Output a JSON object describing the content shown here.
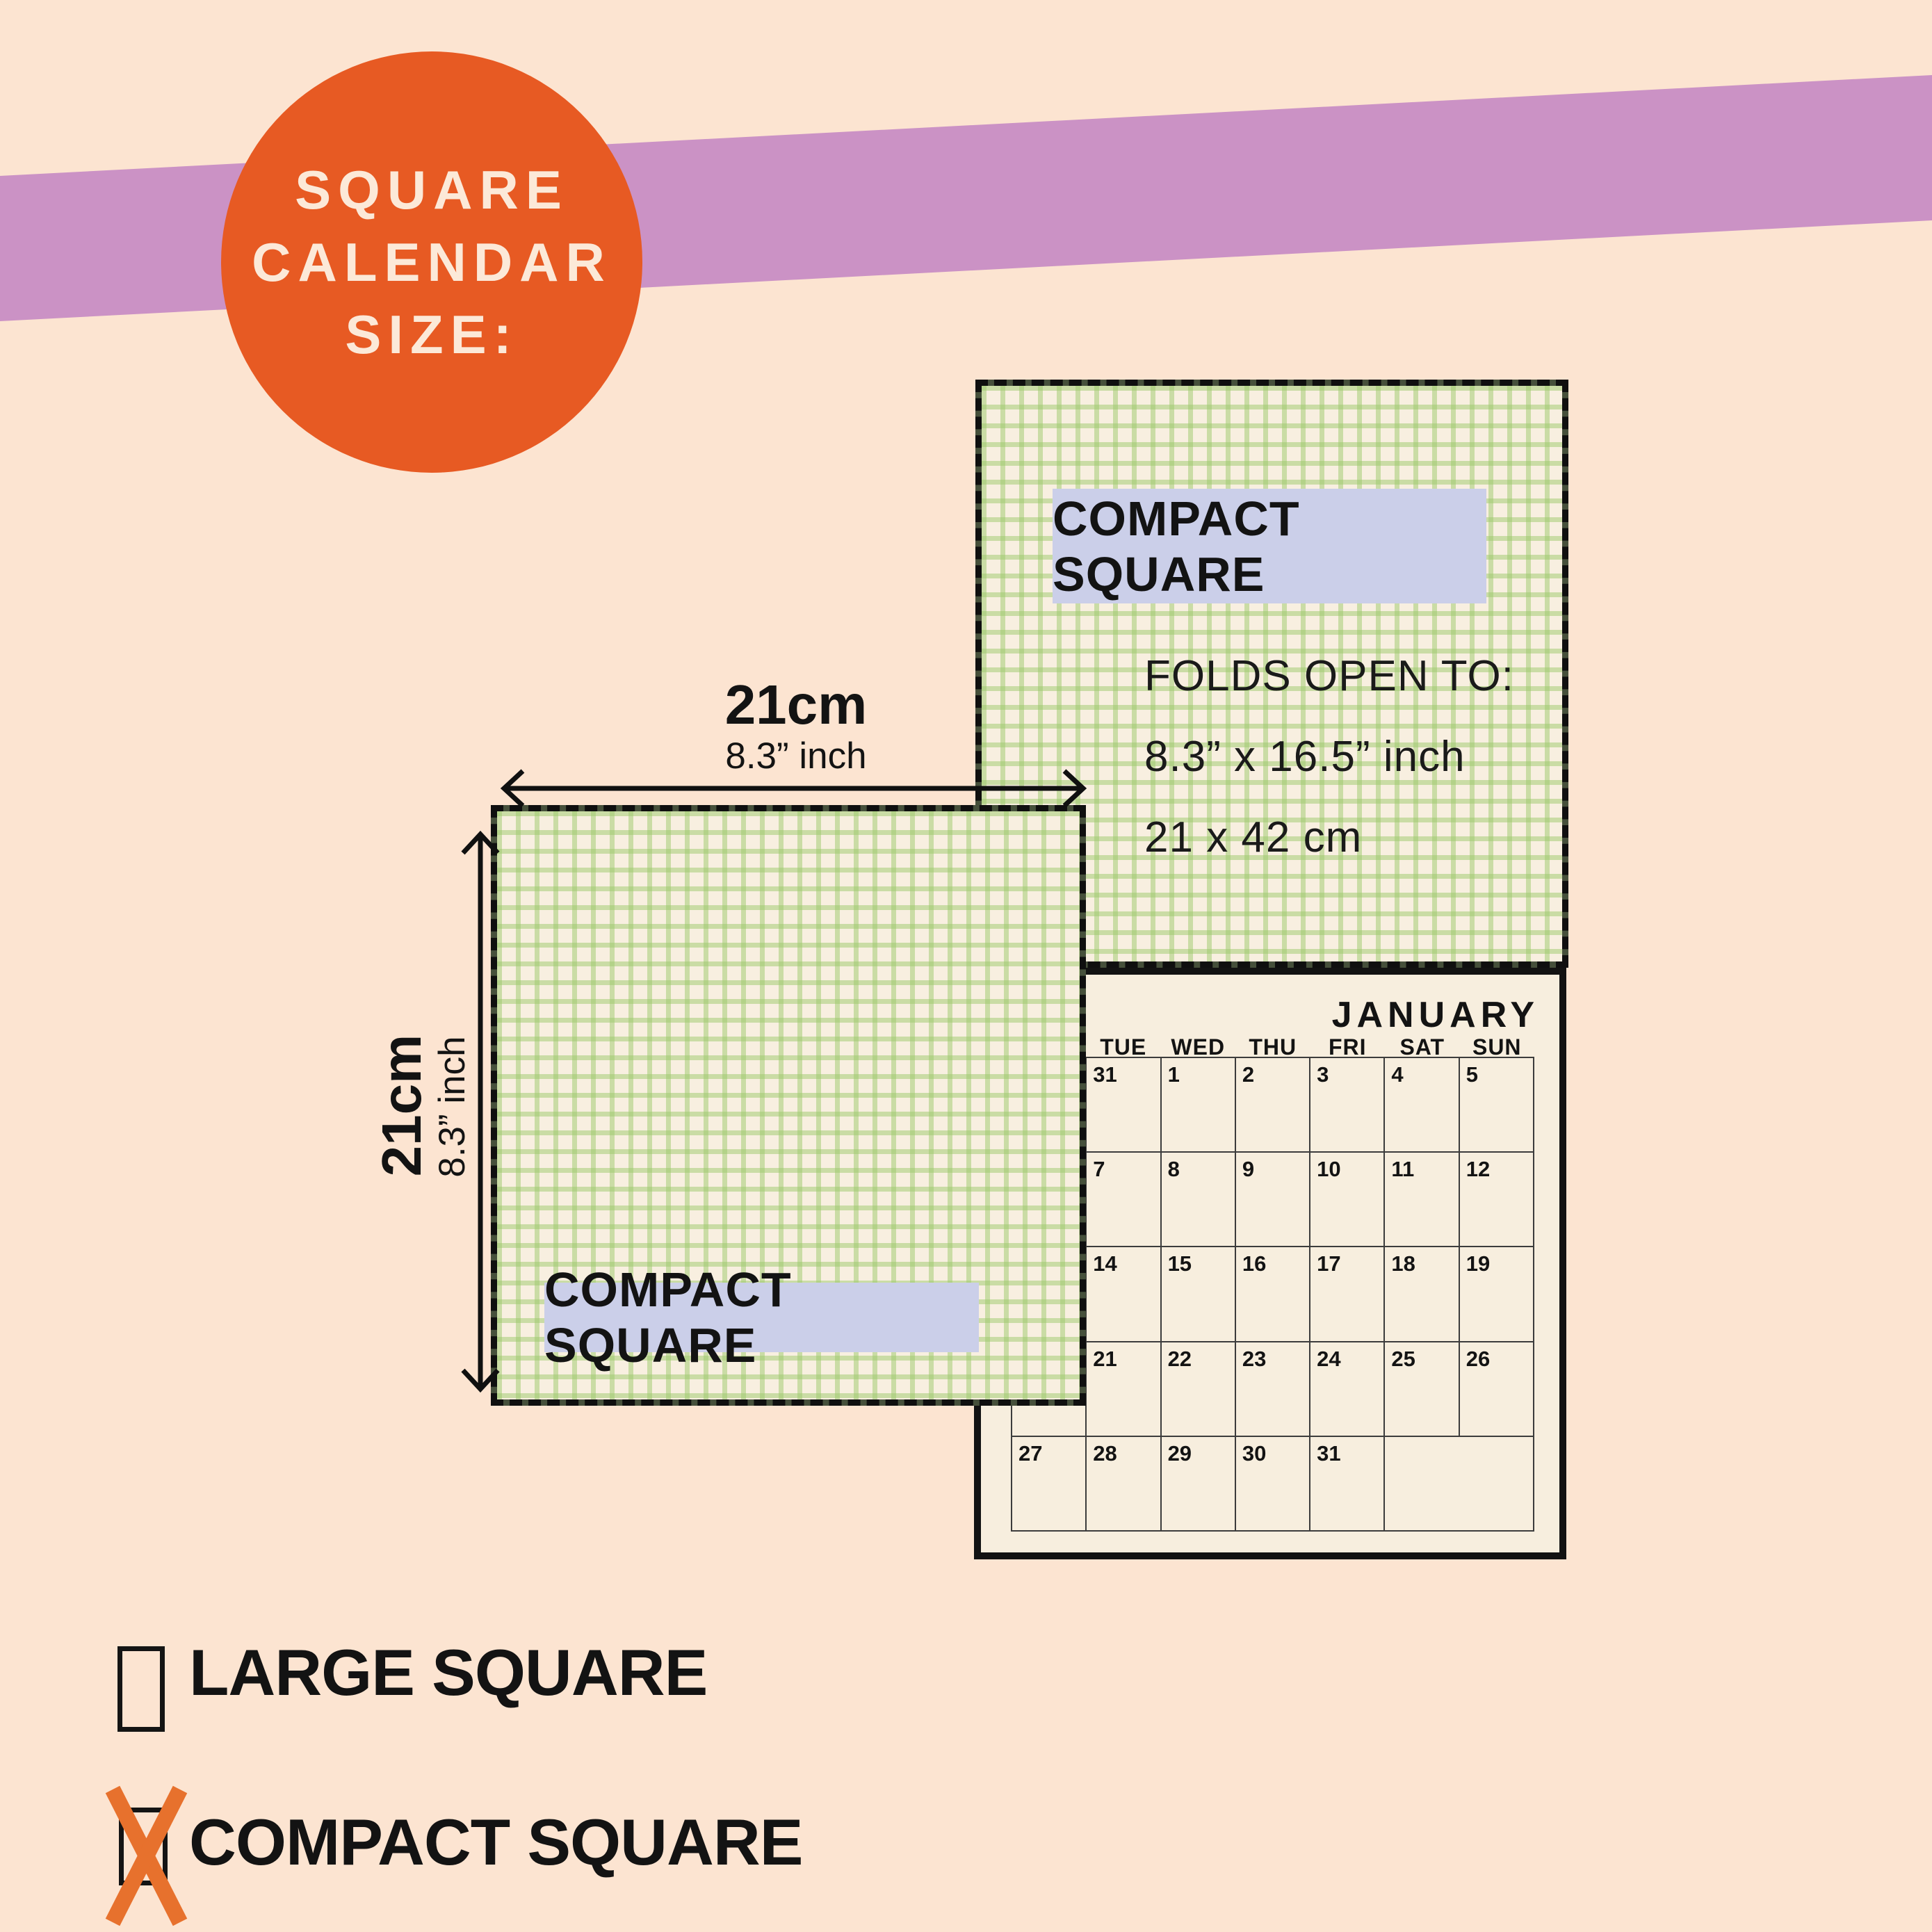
{
  "colors": {
    "peach": "#fce4d1",
    "band": "#cb92c5",
    "orange": "#e75a23",
    "badgetext": "#fce9d8",
    "pagecream": "#f8efe0",
    "greenline": "#9cc96b80",
    "olive": "#46503b",
    "dashink": "#0f0f0f",
    "lavender": "#cbcfe9",
    "ink": "#131313",
    "calbg": "#f7eede",
    "gridline": "#3c3c3c",
    "xorange": "#e7712d"
  },
  "badge": {
    "lines": [
      "SQUARE",
      "CALENDAR",
      "SIZE:"
    ]
  },
  "back_cover": {
    "label": "COMPACT SQUARE",
    "folds": [
      "FOLDS OPEN TO:",
      "8.3” x 16.5” inch",
      "21 x 42 cm"
    ]
  },
  "front_cover": {
    "label": "COMPACT SQUARE"
  },
  "dimensions": {
    "width": {
      "cm": "21cm",
      "inch": "8.3” inch"
    },
    "height": {
      "cm": "21cm",
      "inch": "8.3” inch"
    }
  },
  "calendar": {
    "month": "JANUARY",
    "day_headers": [
      "TUE",
      "WED",
      "THU",
      "FRI",
      "SAT",
      "SUN"
    ],
    "weeks": [
      {
        "cells": [
          {
            "t": ""
          },
          {
            "t": "31"
          },
          {
            "t": "1"
          },
          {
            "t": "2"
          },
          {
            "t": "3"
          },
          {
            "t": "4"
          },
          {
            "t": "5"
          }
        ]
      },
      {
        "cells": [
          {
            "t": ""
          },
          {
            "t": "7"
          },
          {
            "t": "8"
          },
          {
            "t": "9"
          },
          {
            "t": "10"
          },
          {
            "t": "11"
          },
          {
            "t": "12"
          }
        ]
      },
      {
        "cells": [
          {
            "t": ""
          },
          {
            "t": "14"
          },
          {
            "t": "15"
          },
          {
            "t": "16"
          },
          {
            "t": "17"
          },
          {
            "t": "18"
          },
          {
            "t": "19"
          }
        ]
      },
      {
        "cells": [
          {
            "t": ""
          },
          {
            "t": "21"
          },
          {
            "t": "22"
          },
          {
            "t": "23"
          },
          {
            "t": "24"
          },
          {
            "t": "25"
          },
          {
            "t": "26"
          }
        ]
      },
      {
        "cells": [
          {
            "t": "27"
          },
          {
            "t": "28"
          },
          {
            "t": "29"
          },
          {
            "t": "30"
          },
          {
            "t": "31"
          },
          {
            "t": "",
            "span": 2
          }
        ]
      }
    ]
  },
  "options": [
    {
      "label": "LARGE SQUARE",
      "checked": false
    },
    {
      "label": "COMPACT SQUARE",
      "checked": true
    }
  ]
}
